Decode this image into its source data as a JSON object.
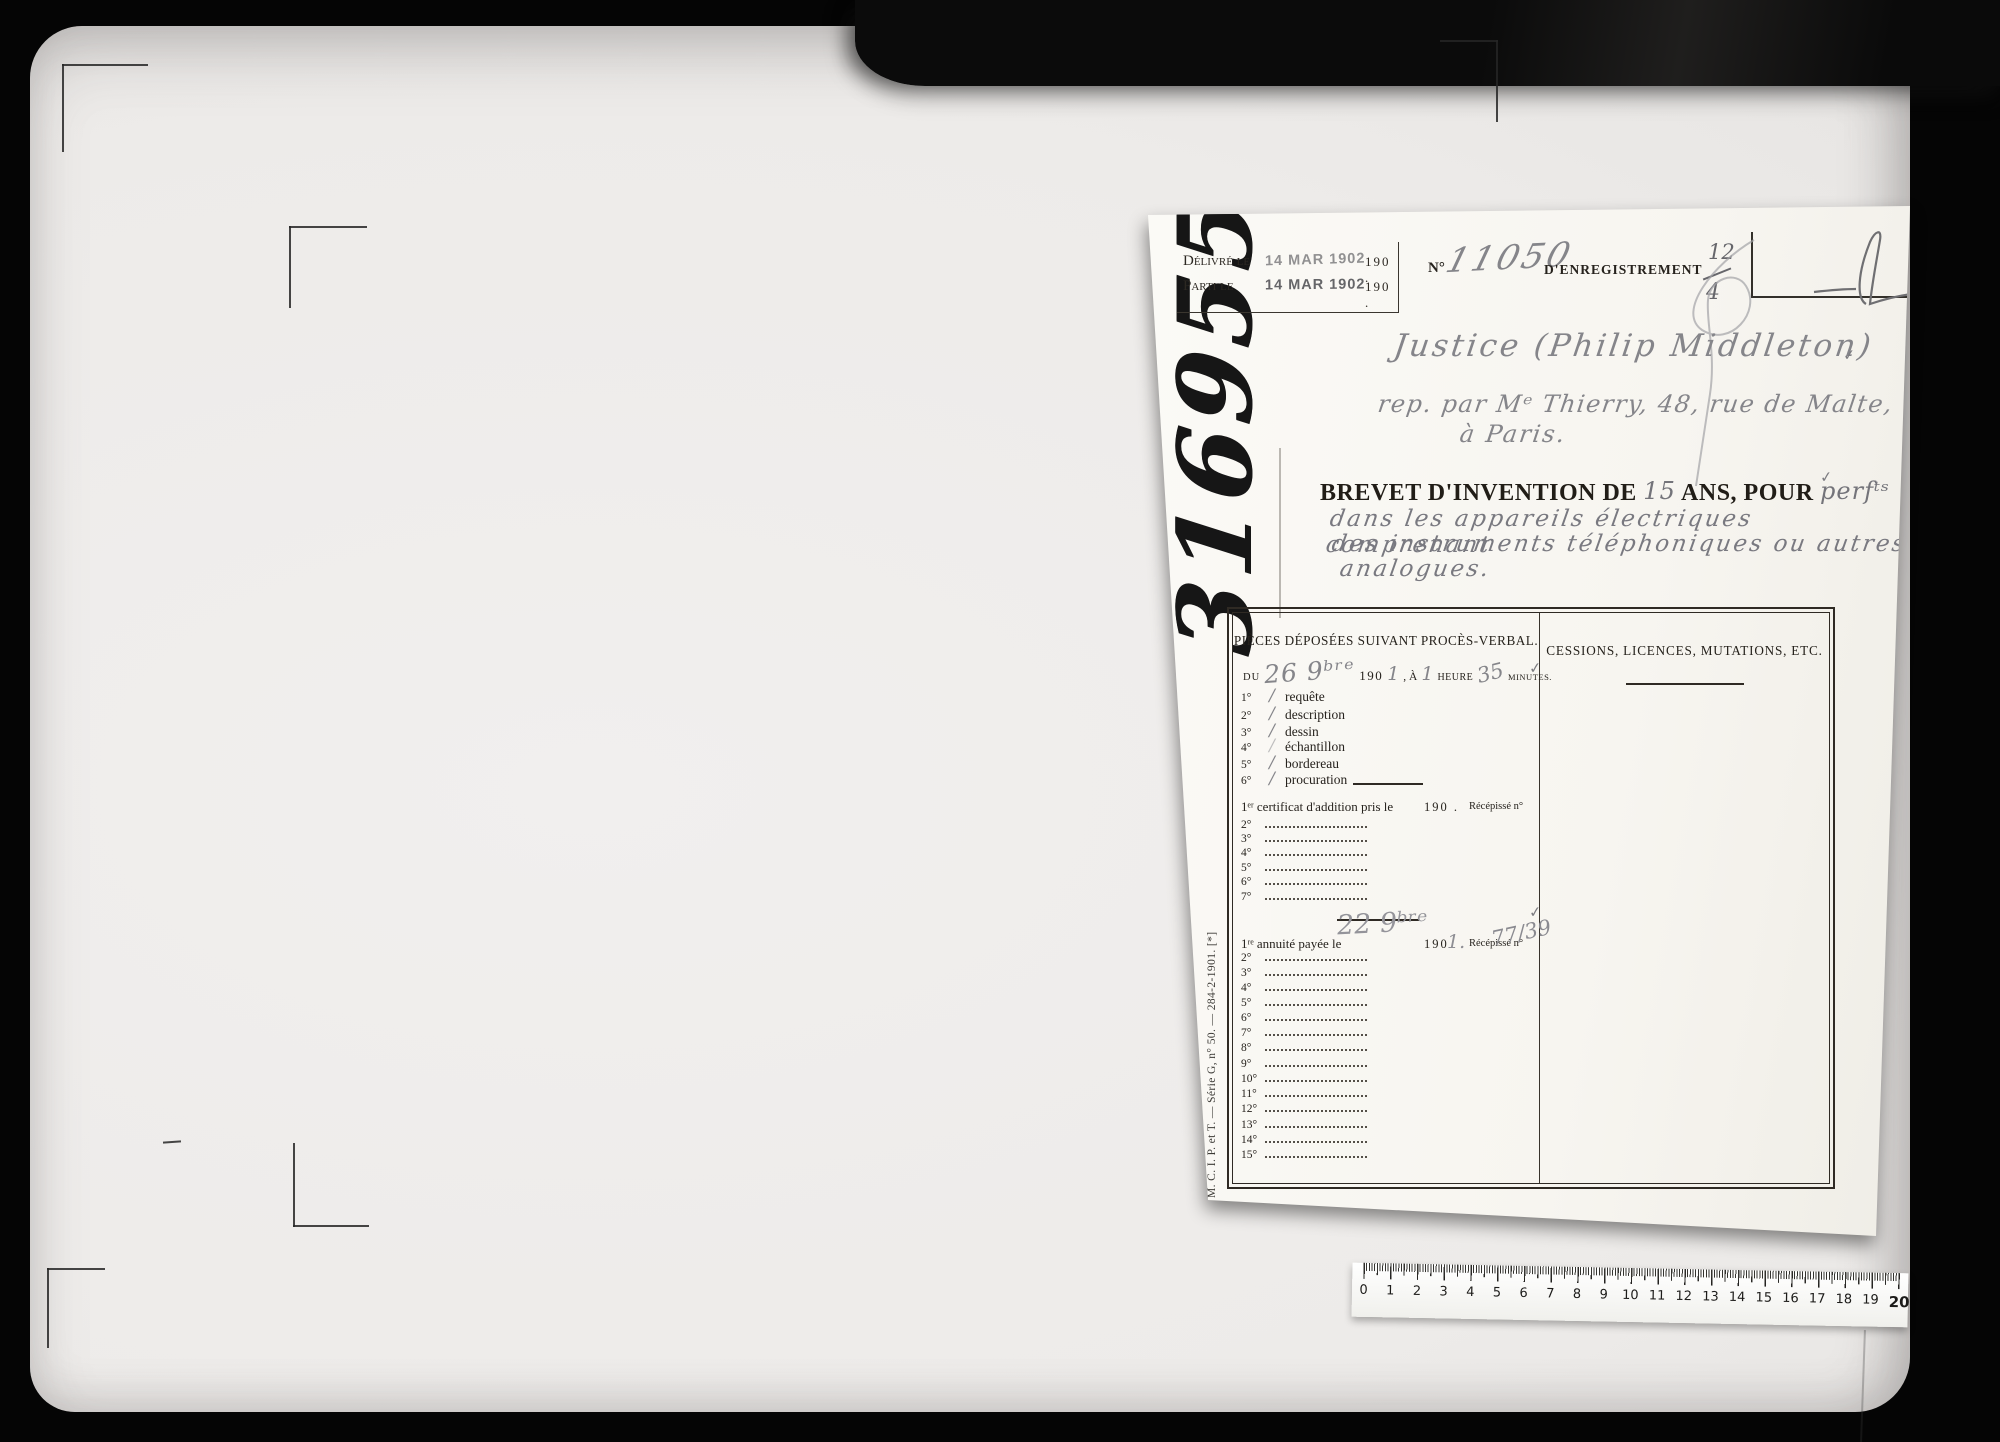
{
  "card": {
    "check": "✓",
    "big_number": "316955",
    "series_note": "M. C. I. P. et T. — Série G, n° 50. — 284-2-1901. [*]",
    "stamp_box": {
      "rows": [
        {
          "label": "Délivré le",
          "stamp": "14 MAR 1902",
          "year": "190 ."
        },
        {
          "label": "Parti le",
          "stamp": "14 MAR 1902",
          "year": "190 ."
        }
      ]
    },
    "registration": {
      "no_label": "N°",
      "number_hw": "11050",
      "label": "D'ENREGISTREMENT",
      "fraction_top": "12",
      "fraction_bottom": "4"
    },
    "addressee": {
      "line1": "Justice (Philip Middleton)",
      "line2": "rep. par Mᵉ Thierry, 48, rue de Malte,",
      "line3": "à Paris."
    },
    "title": {
      "prefix": "BREVET D'INVENTION DE",
      "duration_hw": "15",
      "mid": "ANS, POUR",
      "suffix_hw": "perfᵗˢ",
      "desc_line1": "dans les appareils électriques comprenant",
      "desc_line2": "des instruments téléphoniques ou autres",
      "desc_line3": "analogues."
    },
    "table": {
      "left": {
        "header": "PIÈCES DÉPOSÉES SUIVANT PROCÈS-VERBAL.",
        "sub": {
          "du": "DU",
          "date_hw": "26 9ᵇʳᵉ",
          "year": "190",
          "year_hw": "1",
          "a": ", À",
          "hour_hw": "1",
          "heure": "HEURE",
          "min_hw": "35",
          "minutes": "MINUTES."
        },
        "items": [
          {
            "num": "1°",
            "tick": "/",
            "label": "requête"
          },
          {
            "num": "2°",
            "tick": "/",
            "label": "description"
          },
          {
            "num": "3°",
            "tick": "/",
            "label": "dessin"
          },
          {
            "num": "4°",
            "tick": "/",
            "label": "échantillon"
          },
          {
            "num": "5°",
            "tick": "/",
            "label": "bordereau"
          },
          {
            "num": "6°",
            "tick": "/",
            "label": "procuration"
          }
        ],
        "cert": {
          "label": "1ᵉʳ certificat d'addition pris le",
          "year": "190 .",
          "recepisse": "Récépissé n°",
          "rows": [
            "2°",
            "3°",
            "4°",
            "5°",
            "6°",
            "7°"
          ]
        },
        "annuite": {
          "label": "1ʳᵉ annuité payée le",
          "date_hw": "22 9ᵇʳᵉ",
          "year": "190",
          "year_hw": "1.",
          "recepisse": "Récépissé n°",
          "number_hw": "77/39",
          "rows": [
            "2°",
            "3°",
            "4°",
            "5°",
            "6°",
            "7°",
            "8°",
            "9°",
            "10°",
            "11°",
            "12°",
            "13°",
            "14°",
            "15°"
          ]
        }
      },
      "right": {
        "header": "CESSIONS, LICENCES, MUTATIONS, ETC."
      }
    }
  },
  "ruler": {
    "numbers": [
      "0",
      "1",
      "2",
      "3",
      "4",
      "5",
      "6",
      "7",
      "8",
      "9",
      "10",
      "11",
      "12",
      "13",
      "14",
      "15",
      "16",
      "17",
      "18",
      "19",
      "20"
    ]
  }
}
